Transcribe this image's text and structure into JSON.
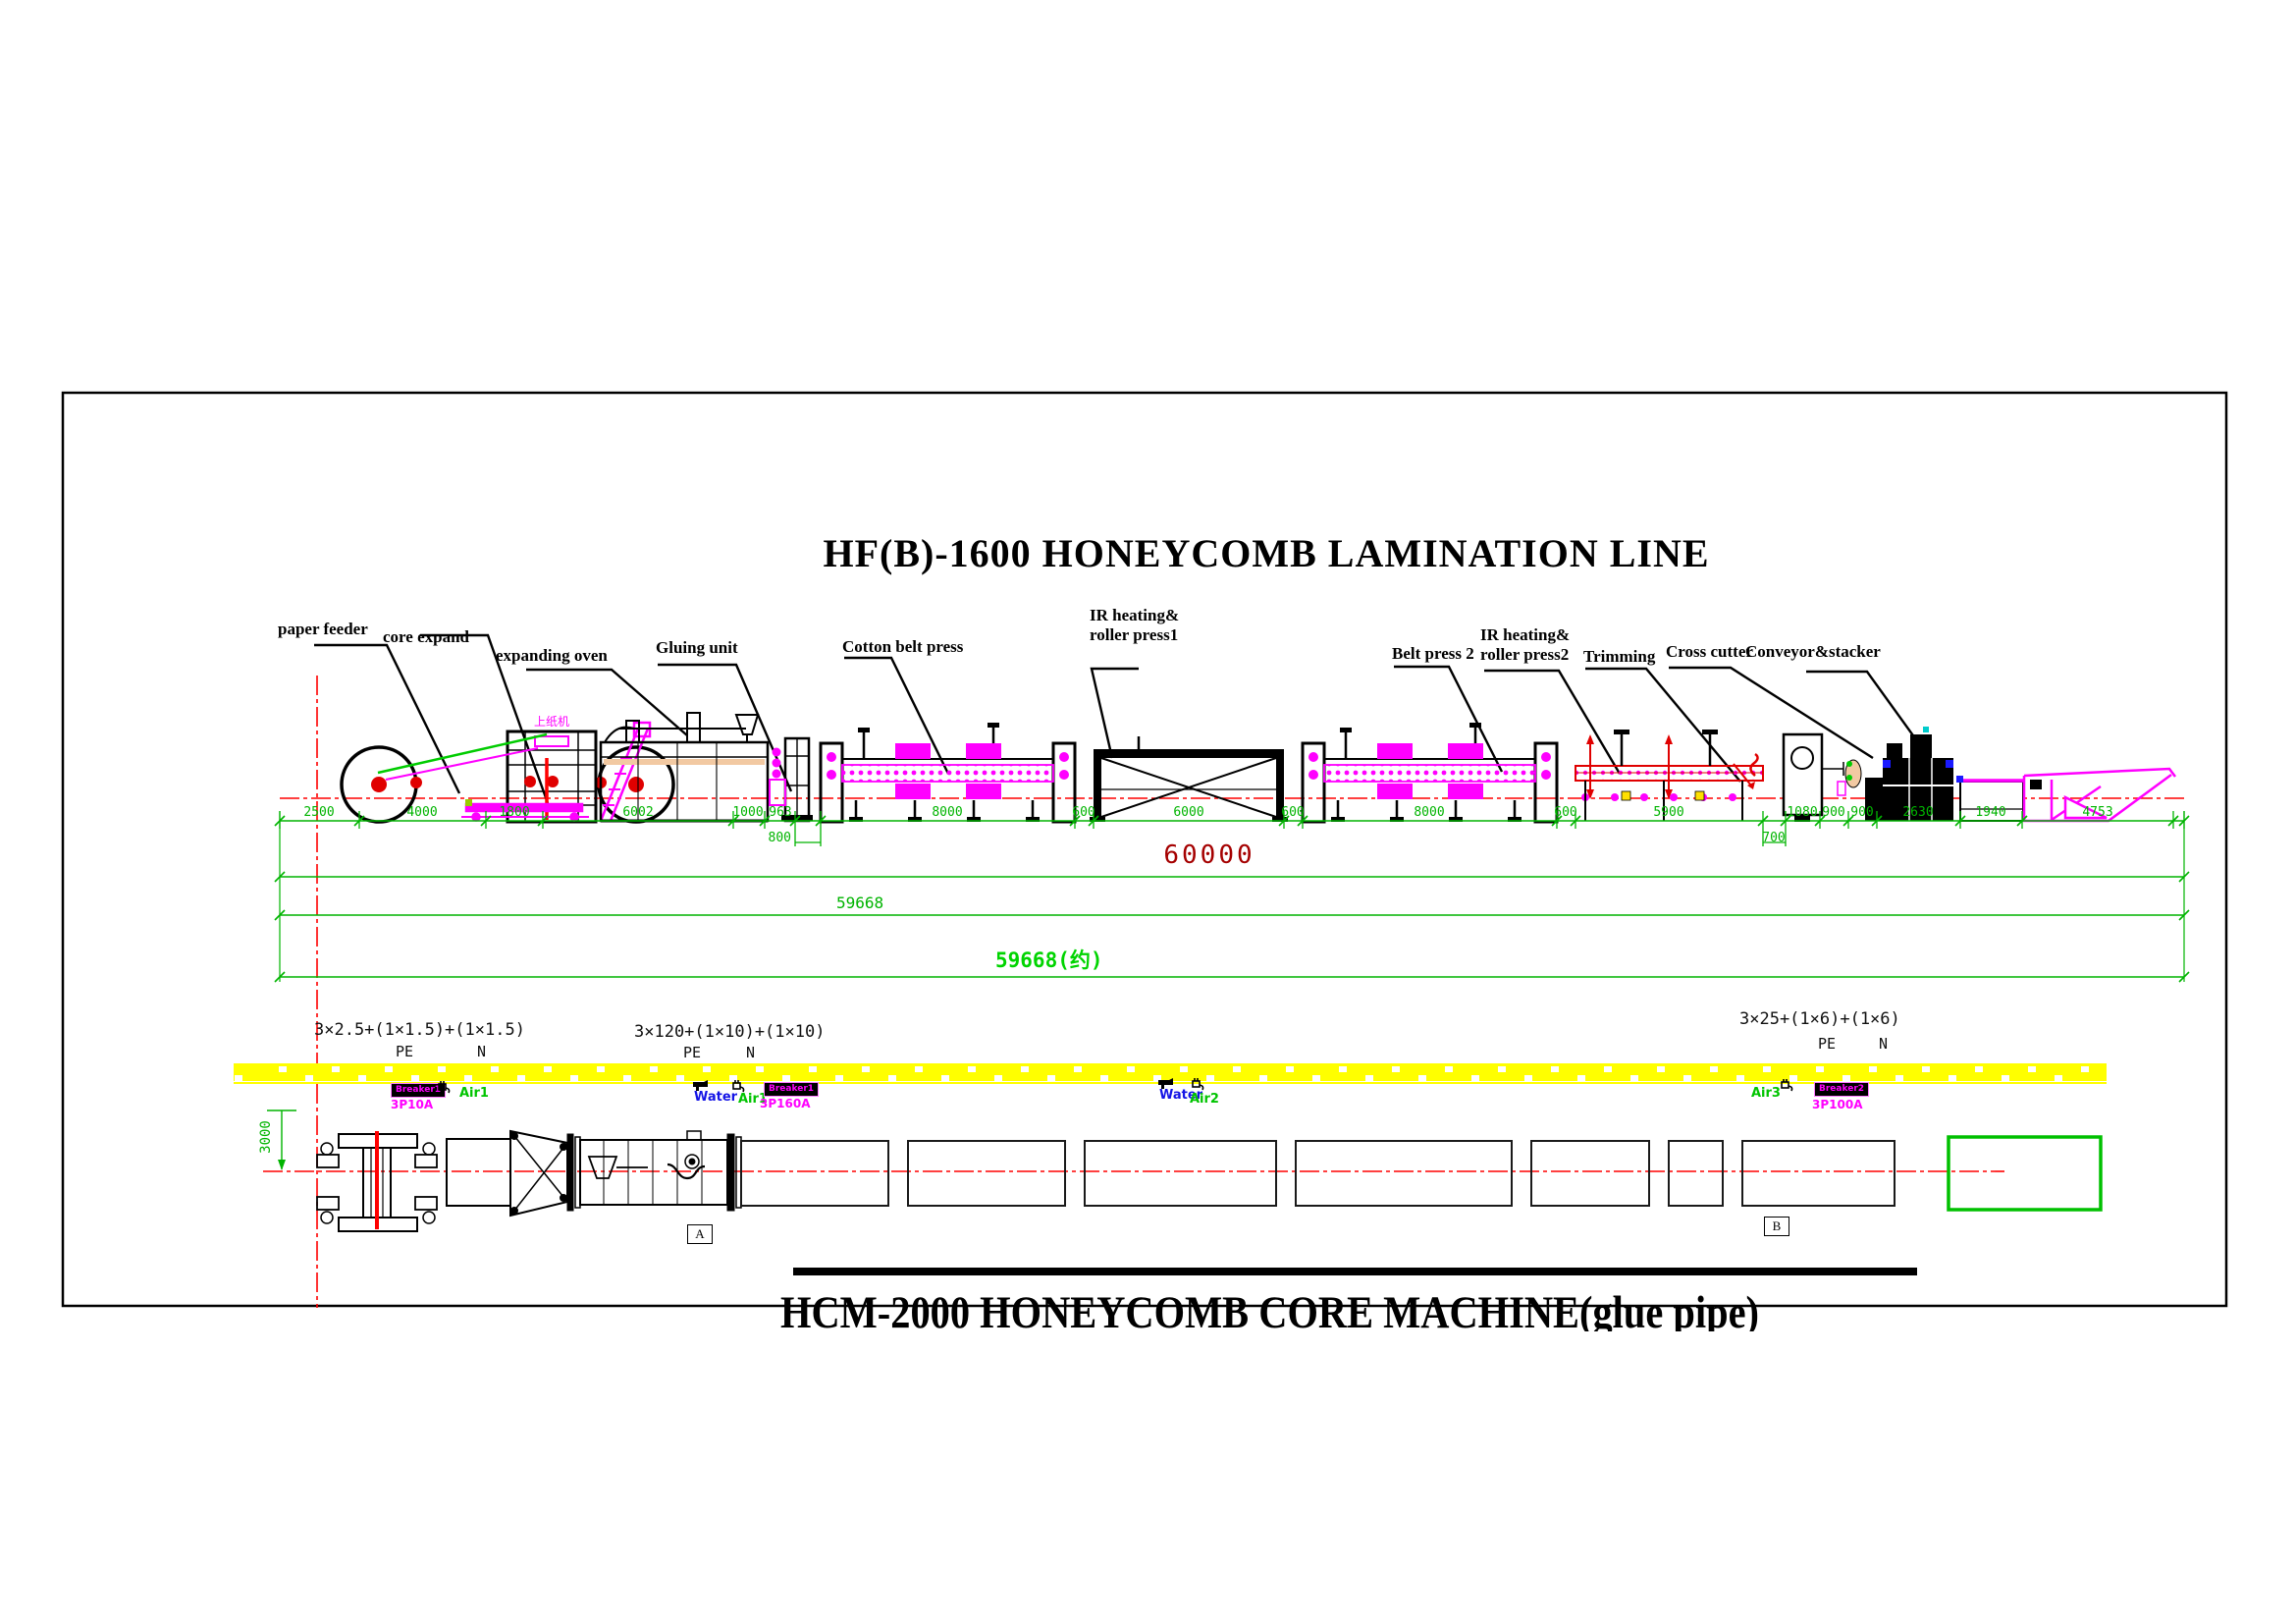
{
  "titles": {
    "main": "HF(B)-1600 HONEYCOMB LAMINATION LINE",
    "bottom": "HCM-2000 HONEYCOMB CORE MACHINE(glue pipe)"
  },
  "machine_labels": {
    "paper_feeder": "paper feeder",
    "core_expand": "core expand",
    "expanding_oven": "expanding oven",
    "gluing_unit": "Gluing unit",
    "cotton_belt_press": "Cotton belt press",
    "ir1_line1": "IR heating&",
    "ir1_line2": "roller press1",
    "belt_press_2": "Belt press 2",
    "ir2_line1": "IR heating&",
    "ir2_line2": "roller press2",
    "trimming": "Trimming",
    "cross_cutter": "Cross cutter",
    "conveyor_stacker": "Conveyor&stacker",
    "feeder_cn": "上纸机"
  },
  "dims": {
    "chain": [
      "2500",
      "4000",
      "1800",
      "6002",
      "1000",
      "963",
      "8000",
      "600",
      "6000",
      "600",
      "8000",
      "600",
      "5900",
      "1080",
      "900",
      "900",
      "2630",
      "1940",
      "4753"
    ],
    "sub_800": "800",
    "sub_700": "700",
    "total_60000": "60000",
    "total_59668": "59668",
    "total_59668_approx": "59668(约)",
    "vertical_3000": "3000"
  },
  "electrical": {
    "cable1": {
      "spec": "3×2.5+(1×1.5)+(1×1.5)",
      "pe": "PE",
      "n": "N"
    },
    "cable2": {
      "spec": "3×120+(1×10)+(1×10)",
      "pe": "PE",
      "n": "N"
    },
    "cable3": {
      "spec": "3×25+(1×6)+(1×6)",
      "pe": "PE",
      "n": "N"
    }
  },
  "utilities": {
    "group1": {
      "breaker": "Breaker1",
      "rating": "3P10A",
      "air": "Air1"
    },
    "group2": {
      "water": "Water",
      "air": "Air1",
      "breaker": "Breaker1",
      "rating": "3P160A"
    },
    "group3": {
      "water": "Water",
      "air": "Air2"
    },
    "group4": {
      "air": "Air3",
      "breaker": "Breaker2",
      "rating": "3P100A"
    }
  },
  "sections": {
    "a": "A",
    "b": "B"
  },
  "colors": {
    "dimension_green": "#00b400",
    "total_red": "#a50000",
    "approx_green": "#00d400",
    "centerline_red": "#ff0000",
    "machine_magenta": "#ff00ff",
    "cable_tray_yellow": "#ffff00",
    "water_blue": "#1414e6",
    "air_green": "#00c400"
  }
}
